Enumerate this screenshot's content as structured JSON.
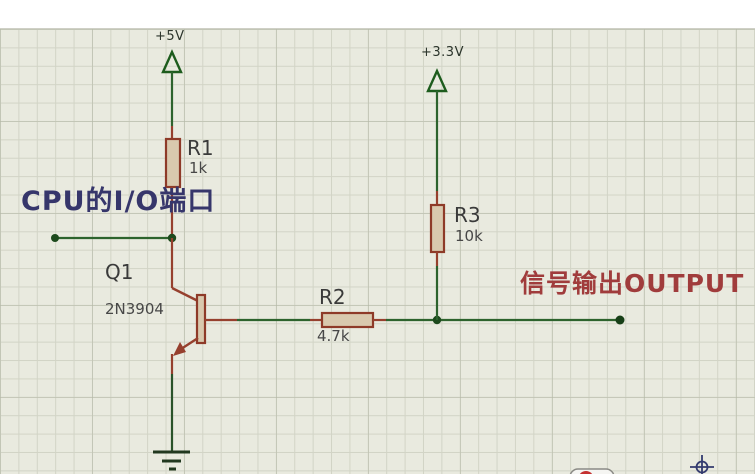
{
  "schematic": {
    "power_rails": [
      {
        "name": "+5V"
      },
      {
        "name": "+3.3V"
      }
    ],
    "components": [
      {
        "ref": "R1",
        "value": "1k",
        "type": "resistor"
      },
      {
        "ref": "R2",
        "value": "4.7k",
        "type": "resistor"
      },
      {
        "ref": "R3",
        "value": "10k",
        "type": "resistor"
      },
      {
        "ref": "Q1",
        "value": "2N3904",
        "type": "npn-transistor"
      }
    ],
    "annotations": [
      {
        "text": "CPU的I/O端口",
        "color": "#36366b"
      },
      {
        "text": "信号输出OUTPUT",
        "color": "#a03c3c"
      }
    ],
    "colors": {
      "canvas_bg": "#e9eadf",
      "grid_line": "#d2d4c6",
      "wire_green": "#2d632d",
      "pin_red": "#96402e",
      "resistor_fill": "#d9c9ae",
      "resistor_border": "#8e3a28",
      "junction_dot": "#1d4a1d",
      "power_flag_green": "#1d5c1d",
      "ground_dark": "#21381f",
      "origin_marker_blue": "#333a6e",
      "text_dark": "#3a3a3a"
    }
  }
}
